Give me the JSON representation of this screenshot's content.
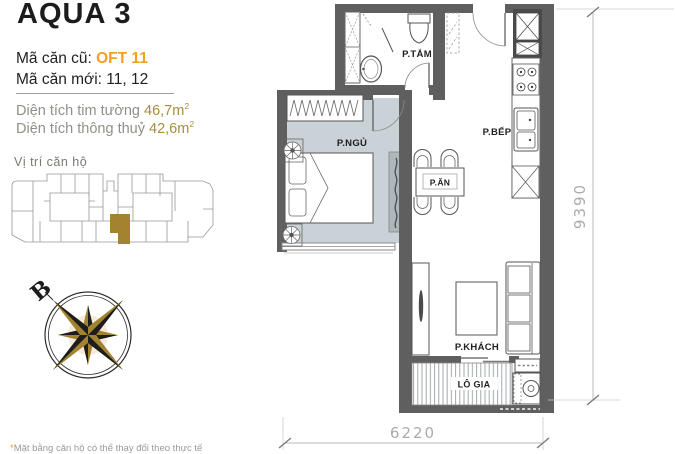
{
  "colors": {
    "accent": "#F59F1F",
    "gold": "#A3832F",
    "area-value": "#A68F3F",
    "wall": "#5F5F5F",
    "floor": "#C9D2D6",
    "dim-text": "#ABABAB",
    "muted": "#90908A"
  },
  "header": {
    "title": "AQUA 3",
    "code_old_label": "Mã căn cũ:",
    "code_old_value": "OFT 11",
    "code_new_label": "Mã căn mới:",
    "code_new_value": "11, 12"
  },
  "areas": {
    "gross_label": "Diện tích tim tường",
    "gross_value": "46,7m",
    "gross_sup": "2",
    "net_label": "Diện tích thông thuỷ",
    "net_value": "42,6m",
    "net_sup": "2"
  },
  "location": {
    "label": "Vị trí căn hộ"
  },
  "compass": {
    "north_label": "B"
  },
  "plan": {
    "rooms": {
      "bathroom": "P.TẮM",
      "bedroom": "P.NGỦ",
      "kitchen": "P.BẾP",
      "dining": "P.ĂN",
      "living": "P.KHÁCH",
      "loggia": "LÔ GIA"
    },
    "dimensions": {
      "height": "9390",
      "width": "6220"
    }
  },
  "footnote": {
    "star": "*",
    "text": "Mặt bằng căn hộ có thể thay đổi theo thực tế"
  }
}
